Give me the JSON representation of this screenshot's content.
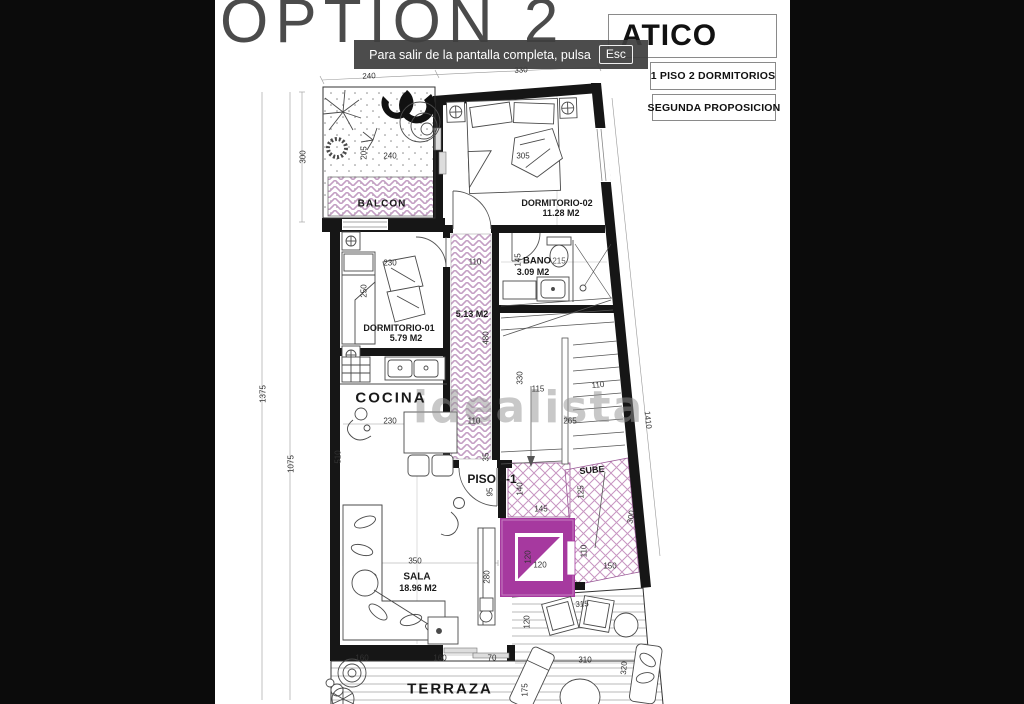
{
  "viewer": {
    "notice_message": "Para salir de la pantalla completa, pulsa",
    "notice_key": "Esc"
  },
  "title_block": {
    "option_label": "OPTION 2",
    "plan_name": "ATICO",
    "spec_line": "1 PISO 2 DORMITORIOS",
    "proposal_line": "SEGUNDA PROPOSICION"
  },
  "watermark": "idealista",
  "colors": {
    "background": "#0b0b0b",
    "paper": "#ffffff",
    "accent_magenta": "#a6399f",
    "hatch_pink": "#c49fc4",
    "notice_bg": "#3e3e3e",
    "option_gray": "#4b4b4b"
  },
  "rooms": {
    "balcon": {
      "name": "BALCON"
    },
    "dormitorio_02": {
      "name": "DORMITORIO-02",
      "area": "11.28 M2"
    },
    "bano": {
      "name": "BANO",
      "area": "3.09 M2"
    },
    "dormitorio_01": {
      "name": "DORMITORIO-01",
      "area": "5.79 M2"
    },
    "pasillo": {
      "area": "5.13 M2"
    },
    "cocina": {
      "name": "COCINA"
    },
    "piso": {
      "name": "PISO 4-1"
    },
    "escalera": {
      "name": "SUBE"
    },
    "sala": {
      "name": "SALA",
      "area": "18.96 M2"
    },
    "terraza": {
      "name": "TERRAZA"
    }
  },
  "dimensions": {
    "top_240": "240",
    "top_330": "330",
    "left_300": "300",
    "left_1375": "1375",
    "left_1075": "1075",
    "balcon_205": "205",
    "balcon_240": "240",
    "dorm2_305": "305",
    "pasillo_110": "110",
    "pasillo_480": "480",
    "bano_145": "145",
    "bano_215": "215",
    "dorm1_230": "230",
    "dorm1_250": "250",
    "escalera_330": "330",
    "escalera_115": "115",
    "escalera_110": "110",
    "escalera_265": "265",
    "cocina_510": "510",
    "cocina_230": "230",
    "cocina_110": "110",
    "cocina_35": "35",
    "piso_95": "95",
    "descanso_140": "140",
    "descanso_145": "145",
    "sube_125": "125",
    "sube_300": "300",
    "sube_110": "110",
    "sube_150": "150",
    "ascensor_120a": "120",
    "ascensor_120b": "120",
    "sala_350": "350",
    "sala_280": "280",
    "terraza_160a": "160",
    "terraza_160b": "160",
    "terraza_70": "70",
    "terraza_315": "315",
    "terraza_120": "120",
    "terraza_310": "310",
    "terraza_175": "175",
    "terraza_320": "320",
    "right_1410": "1410"
  }
}
